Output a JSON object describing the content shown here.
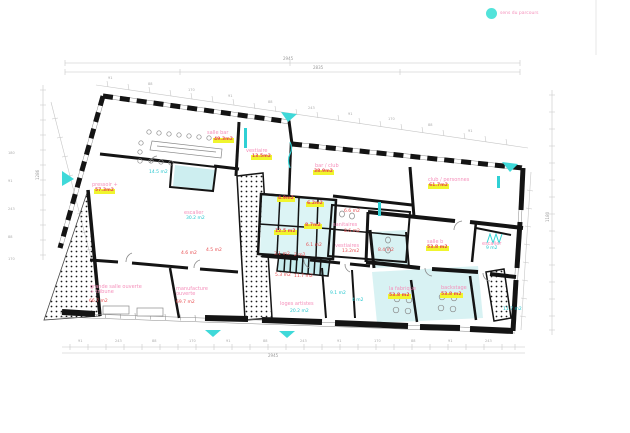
{
  "legend": {
    "label": "sens du parcours",
    "dot_color": "#52e3da"
  },
  "colors": {
    "accent_cyan": "#3fd9d9",
    "room_fill_cyan": "#d8f2f3",
    "label_pink": "#f590bb",
    "label_red": "#e84f52",
    "badge_yellow": "#f0f52e",
    "wall_black": "#141414",
    "dimension_gray": "#c0c0c0"
  },
  "rooms": [
    {
      "name": "salle bar",
      "area": "49.3m2"
    },
    {
      "name": "vestiaire",
      "area": "13.5m2"
    },
    {
      "name": "pressoir +",
      "area": "57.3m2"
    },
    {
      "name": "bar / club",
      "area": "38.9m2"
    },
    {
      "name": "club / personnes",
      "area": "61.7m2"
    },
    {
      "area": "14.5 m2"
    },
    {
      "name": "escalier",
      "area": "30.2 m2"
    },
    {
      "area": "4.6 m2"
    },
    {
      "area": "4.5 m2"
    },
    {
      "name": "grande salle ouverte",
      "name2": "+ tribune",
      "area": "66.7 m2"
    },
    {
      "name": "manufacture",
      "name2": "ouverte",
      "area": "69.7 m2"
    },
    {
      "area": "4.9m2"
    },
    {
      "area": "6.2m2"
    },
    {
      "area": "8.7m2"
    },
    {
      "area": "12.5 m2"
    },
    {
      "area": "6.1 m2"
    },
    {
      "area": "3.1 m2"
    },
    {
      "area": "2 m2"
    },
    {
      "area": "6.6 m2"
    },
    {
      "name": "sanitaires",
      "area": "8.6 m2"
    },
    {
      "name": "vestiaires",
      "area": "13.2m2"
    },
    {
      "area": "5.3 m2"
    },
    {
      "area": "11.7 m2"
    },
    {
      "area": "9.1 m2"
    },
    {
      "area": "4 m2"
    },
    {
      "name": "loges artistes",
      "area": "20.2 m2"
    },
    {
      "area": "8.4 m2"
    },
    {
      "name": "salle b",
      "area": "53.8 m2"
    },
    {
      "name": "escalier",
      "area": "9 m2"
    },
    {
      "name": "la fabrique",
      "area": "53.8 m2"
    },
    {
      "name": "backstage",
      "area": "53.8 m2"
    },
    {
      "area": "11.7 m2"
    }
  ],
  "dims": {
    "top_total": "2945",
    "top_sub": "2835",
    "bottom_total": "2945",
    "left_total": "1286",
    "right_total": "1180",
    "chain_top": [
      "91",
      "88",
      "170",
      "91",
      "88",
      "243",
      "91",
      "170",
      "88",
      "91"
    ],
    "chain_bottom": [
      "91",
      "243",
      "88",
      "170",
      "91",
      "88",
      "243",
      "91",
      "170",
      "88",
      "91",
      "243"
    ],
    "chain_left": [
      "180",
      "91",
      "243",
      "88",
      "170"
    ]
  }
}
